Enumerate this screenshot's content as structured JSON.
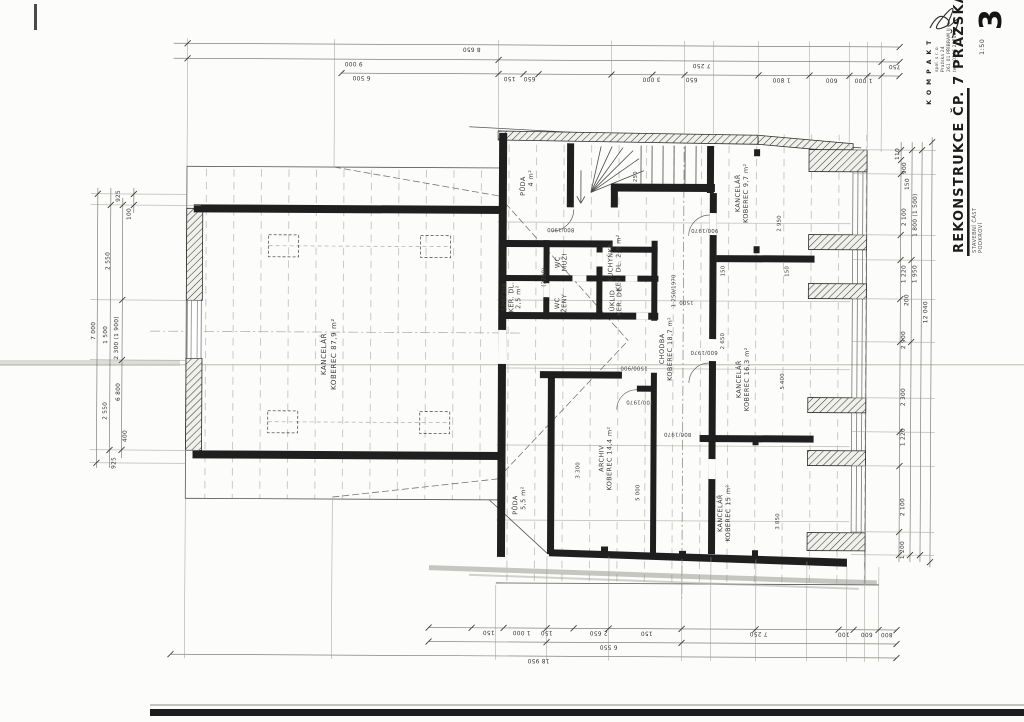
{
  "sheet": {
    "number": "3",
    "scale": "1:50",
    "title": "REKONSTRUKCE  ČP. 7  PRAŽSKÁ",
    "subtitle1": "STAVEBNÍ ČÁST",
    "subtitle2": "PODKROVÍ"
  },
  "stamp": {
    "l1": "K O M P A K T",
    "l2": "spol. s r. o.",
    "l3": "Pražská 24",
    "l4": "261 01  PŘÍBRAM II",
    "l5": "tel.: 0306  28708"
  },
  "rooms": [
    {
      "l1": "KANCELÁŘ",
      "l2": "KOBEREC 87,9 m²"
    },
    {
      "l1": "PŮDA",
      "l2": "4 m²"
    },
    {
      "l1": "SPRCHA",
      "l2": "KER. DL.",
      "l3": "2,5 m²"
    },
    {
      "l1": "WC",
      "l2": "MUŽI"
    },
    {
      "l1": "WC",
      "l2": "ŽENY"
    },
    {
      "l1": "KUCHYŇKA",
      "l2": "KER. DL. 2,8 m²"
    },
    {
      "l1": "ÚKLID",
      "l2": "KER. DL."
    },
    {
      "l1": "CHODBA",
      "l2": "KOBEREC 18,7 m²"
    },
    {
      "l1": "KANCELÁŘ",
      "l2": "KOBEREC 9,7 m²"
    },
    {
      "l1": "KANCELÁŘ",
      "l2": "KOBEREC 16,3 m²"
    },
    {
      "l1": "KANCELÁŘ",
      "l2": "KOBEREC 15 m²"
    },
    {
      "l1": "ARCHIV",
      "l2": "KOBEREC 14,4 m²"
    },
    {
      "l1": "PŮDA",
      "l2": "5,5 m²"
    }
  ],
  "dims_top": [
    "8 650",
    "9 000",
    "7 250",
    "6 500",
    "150",
    "650",
    "3 000",
    "650",
    "1 800",
    "600",
    "1 000",
    "750"
  ],
  "dims_bottom": [
    "150",
    "1 000",
    "150",
    "2 650",
    "150",
    "7 250",
    "100",
    "600",
    "800",
    "6 550",
    "18 950"
  ],
  "dims_left": [
    "925",
    "100",
    "2 550",
    "7 000",
    "1 500",
    "2 300 (1 900)",
    "6 800",
    "2 550",
    "400",
    "925"
  ],
  "dims_right": [
    "110",
    "900",
    "150",
    "2 100",
    "1 800 (1 500)",
    "1 220",
    "1 950",
    "200",
    "2 900",
    "12 040",
    "2 300",
    "1 220",
    "2 100",
    "1 200"
  ],
  "annotations": [
    "(2200)",
    "800/1900",
    "900/1970",
    "1 250/1970",
    "1500",
    "1500/900",
    "600/1970",
    "2 950",
    "150",
    "150",
    "2 650",
    "5 400",
    "800/1970",
    "3 850",
    "5 000",
    "3 300",
    "250",
    "700/1970"
  ]
}
